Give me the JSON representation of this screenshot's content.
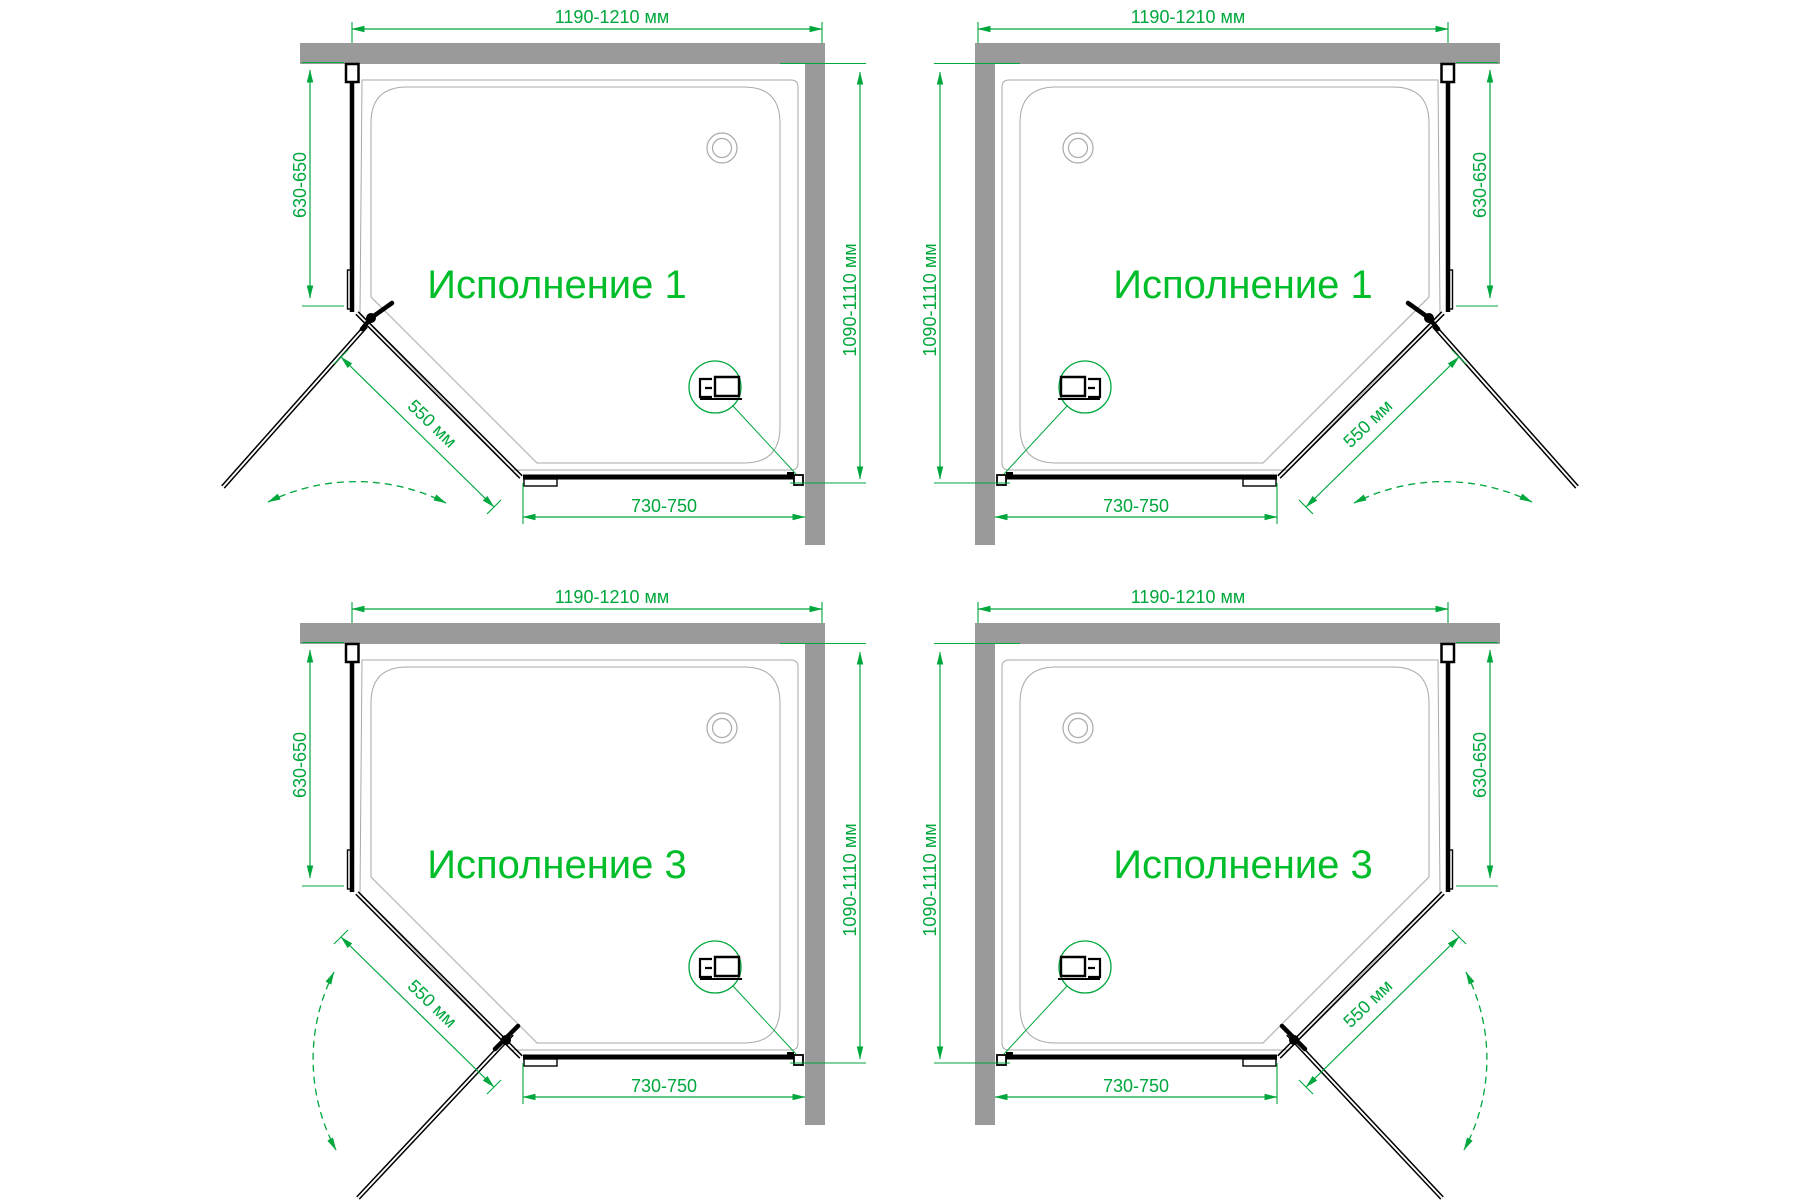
{
  "colors": {
    "background": "#ffffff",
    "dimension_green": "#00a73c",
    "title_green": "#00bd2a",
    "wall_gray": "#9a9a9a",
    "tray_line_gray": "#a9a9a9",
    "glass_black": "#000000"
  },
  "icons": {
    "drain": "drain-circle-icon",
    "wall_profile_detail": "profile-cross-section-icon",
    "door_swing": "swing-arc-arrows-icon"
  },
  "panels": [
    {
      "id": "top-left",
      "title": "Исполнение 1",
      "mirrored": false,
      "dimensions": {
        "top_width": "1190-1210 мм",
        "side_height": "630-650",
        "wall_side_height": "1090-1110 мм",
        "door_diagonal": "550 мм",
        "bottom_width": "730-750"
      }
    },
    {
      "id": "top-right",
      "title": "Исполнение 1",
      "mirrored": true,
      "dimensions": {
        "top_width": "1190-1210 мм",
        "side_height": "630-650",
        "wall_side_height": "1090-1110 мм",
        "door_diagonal": "550 мм",
        "bottom_width": "730-750"
      }
    },
    {
      "id": "bottom-left",
      "title": "Исполнение 3",
      "mirrored": false,
      "dimensions": {
        "top_width": "1190-1210 мм",
        "side_height": "630-650",
        "wall_side_height": "1090-1110 мм",
        "door_diagonal": "550 мм",
        "bottom_width": "730-750"
      }
    },
    {
      "id": "bottom-right",
      "title": "Исполнение 3",
      "mirrored": true,
      "dimensions": {
        "top_width": "1190-1210 мм",
        "side_height": "630-650",
        "wall_side_height": "1090-1110 мм",
        "door_diagonal": "550 мм",
        "bottom_width": "730-750"
      }
    }
  ]
}
